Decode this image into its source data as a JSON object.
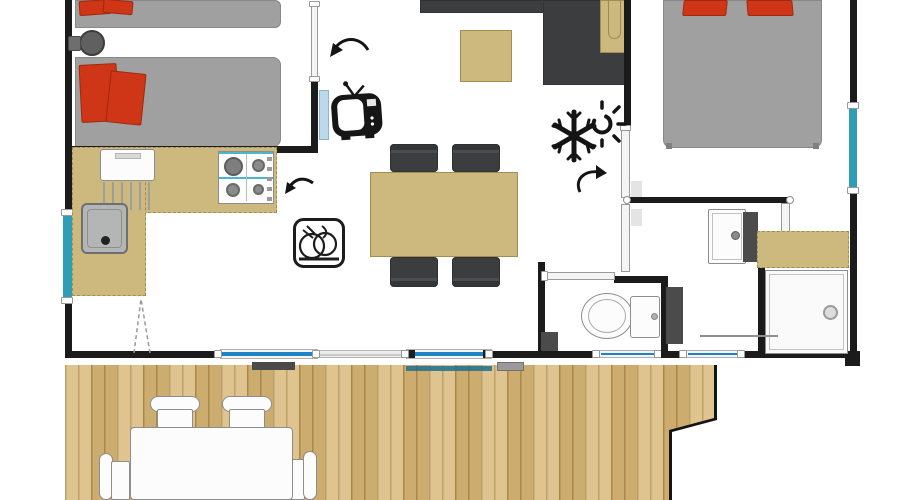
{
  "document": {
    "type": "floor-plan",
    "subject": "mobile-home / chalet layout with terrace",
    "visible_text": ""
  },
  "colors": {
    "wall": "#1b1b1b",
    "floor": "#ffffff",
    "wood_deck": "#d9b97a",
    "wood_plank_line": "#b08f4e",
    "furniture_tan": "#cdb87e",
    "furniture_tan_border": "#a28e54",
    "mattress_gray": "#a0a0a0",
    "mattress_border": "#878787",
    "pillow_red": "#cf3517",
    "pillow_red_dark": "#9e2a0e",
    "seat_dark": "#3b3d3f",
    "window_teal": "#2f9db6",
    "glass_blue": "#1e83c2",
    "fixture_white": "#fcfcfc",
    "fixture_border": "#8d8d8d",
    "door_panel": "#f4f4f4",
    "door_blue": "#bcd9ec",
    "appliance_gray": "#b7b7b7",
    "dark_panel": "#4b4b4b",
    "icon_black": "#161616"
  },
  "icons": [
    "tv-icon",
    "dishwasher-icon",
    "snowflake-icon",
    "sun-icon",
    "door-swing-arrow-icon",
    "kitchen-arrow-icon"
  ],
  "rooms": [
    {
      "name": "twin-bedroom",
      "furniture": [
        "single-bed x2",
        "red-pillows",
        "bedside-stool",
        "sliding-door",
        "hinged-door"
      ]
    },
    {
      "name": "kitchen",
      "furniture": [
        "l-shaped-counter",
        "sink-with-drainer",
        "gas-hob-4-burners",
        "white-appliance",
        "dishwasher-icon"
      ]
    },
    {
      "name": "living-dining",
      "furniture": [
        "corner-sofa",
        "corner-armchair",
        "coffee-table",
        "dining-table",
        "dining-chair x4",
        "wall-tv",
        "climate-icon"
      ]
    },
    {
      "name": "master-bedroom",
      "furniture": [
        "double-bed",
        "red-pillows x2",
        "side-window"
      ]
    },
    {
      "name": "bathroom",
      "furniture": [
        "washbasin",
        "vanity-panel",
        "tan-counter",
        "shower-cabin",
        "towel-bar",
        "door"
      ]
    },
    {
      "name": "wc",
      "furniture": [
        "toilet",
        "cistern",
        "technical-panel",
        "bin",
        "sliding-door",
        "window"
      ]
    },
    {
      "name": "terrace",
      "furniture": [
        "wood-deck",
        "outdoor-table",
        "outdoor-chair x4",
        "doormat x2"
      ]
    }
  ],
  "openings": {
    "left_wall_window": 1,
    "right_wall_window": 1,
    "rear_sliding_glass_doors": 4,
    "open_door_track": 1
  }
}
